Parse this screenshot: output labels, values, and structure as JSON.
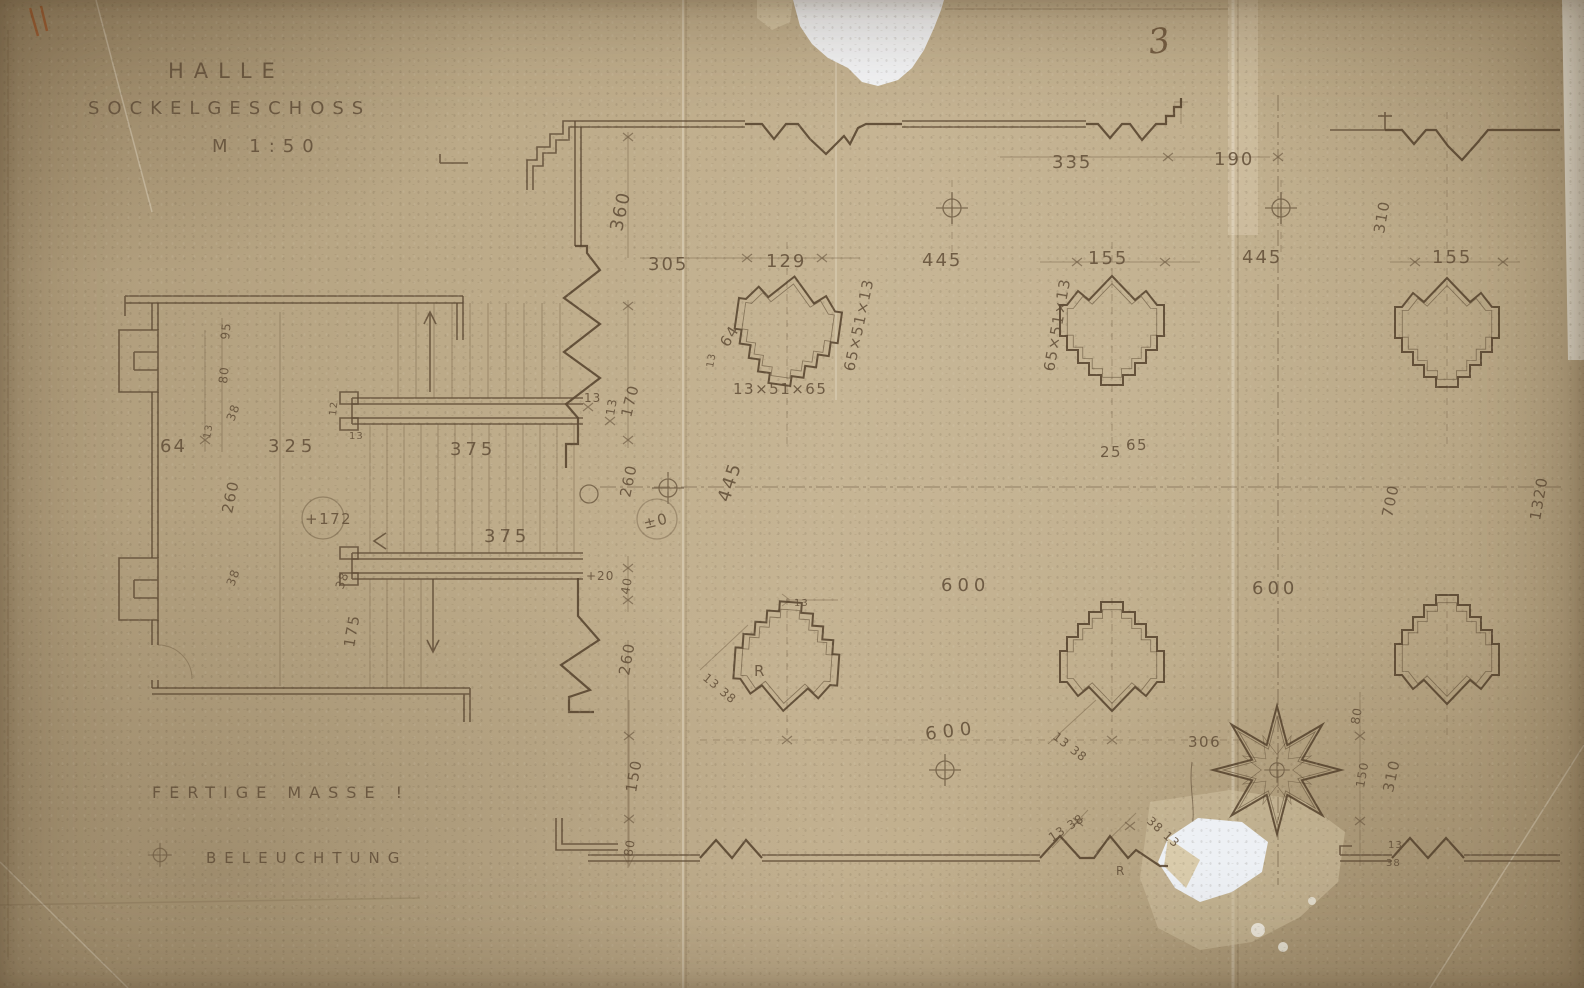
{
  "meta": {
    "sheet_number": "3",
    "drawing_type": "floor-plan-pencil-on-aged-paper"
  },
  "title": {
    "line1": "HALLE",
    "line2": "SOCKELGESCHOSS",
    "scale": "M 1:50"
  },
  "legend": {
    "finished": "FERTIGE MASSE !",
    "lighting": "BELEUCHTUNG",
    "lighting_symbol": "circle-crosshair-icon"
  },
  "levels": {
    "stair": "+172",
    "hall": "±0"
  },
  "colors": {
    "paper": "#bcaa88",
    "ink": "#5e4a34",
    "tear_white": "#f2f3f6",
    "damage_beige": "#d2c4a4"
  },
  "dims": {
    "wall_335": "335",
    "gap_190": "190",
    "bay_360": "360",
    "bay_305": "305",
    "col_129": "129",
    "bay_445_a": "445",
    "col_155_a": "155",
    "bay_445_b": "445",
    "col_155_b": "155",
    "right_310_a": "310",
    "stair_170": "170",
    "stair_13_a": "13",
    "stair_13_b": "13",
    "profile_95": "95",
    "profile_80": "80",
    "profile_38_a": "38",
    "profile_13_c": "13",
    "niche_64": "64",
    "room_325": "325",
    "tread_12": "12",
    "tread_13": "13",
    "flight_375_a": "375",
    "room_260_a": "260",
    "wall_38_b": "38",
    "wall_38_c": "38",
    "room_175": "175",
    "flight_375_b": "375",
    "step_20": "+20",
    "step_40": "40",
    "hall_260": "260",
    "axis_445": "445",
    "wall_260_b": "260",
    "wall_150": "150",
    "wall_80": "80",
    "col1_chain_v": "65×51×13",
    "col1_64": "64",
    "col1_13": "13",
    "col1_chain_h": "13×51×65",
    "col2_chain_v": "65×51×13",
    "col2_25": "25",
    "col2_65": "65",
    "axis_700": "700",
    "axis_1320": "1320",
    "bay_600_a": "600",
    "bay_600_b": "600",
    "bay_600_c": "600",
    "bay_306": "306",
    "col4_13": "13",
    "col4_13_38": "13 38",
    "col4_r": "R",
    "col5_13_38": "13 38",
    "star_80": "80",
    "star_150": "150",
    "star_310": "310",
    "bwall_13_38": "13 38",
    "bwall_38_13": "38 13",
    "bwall_r": "R",
    "br_13": "13",
    "br_38": "38"
  }
}
